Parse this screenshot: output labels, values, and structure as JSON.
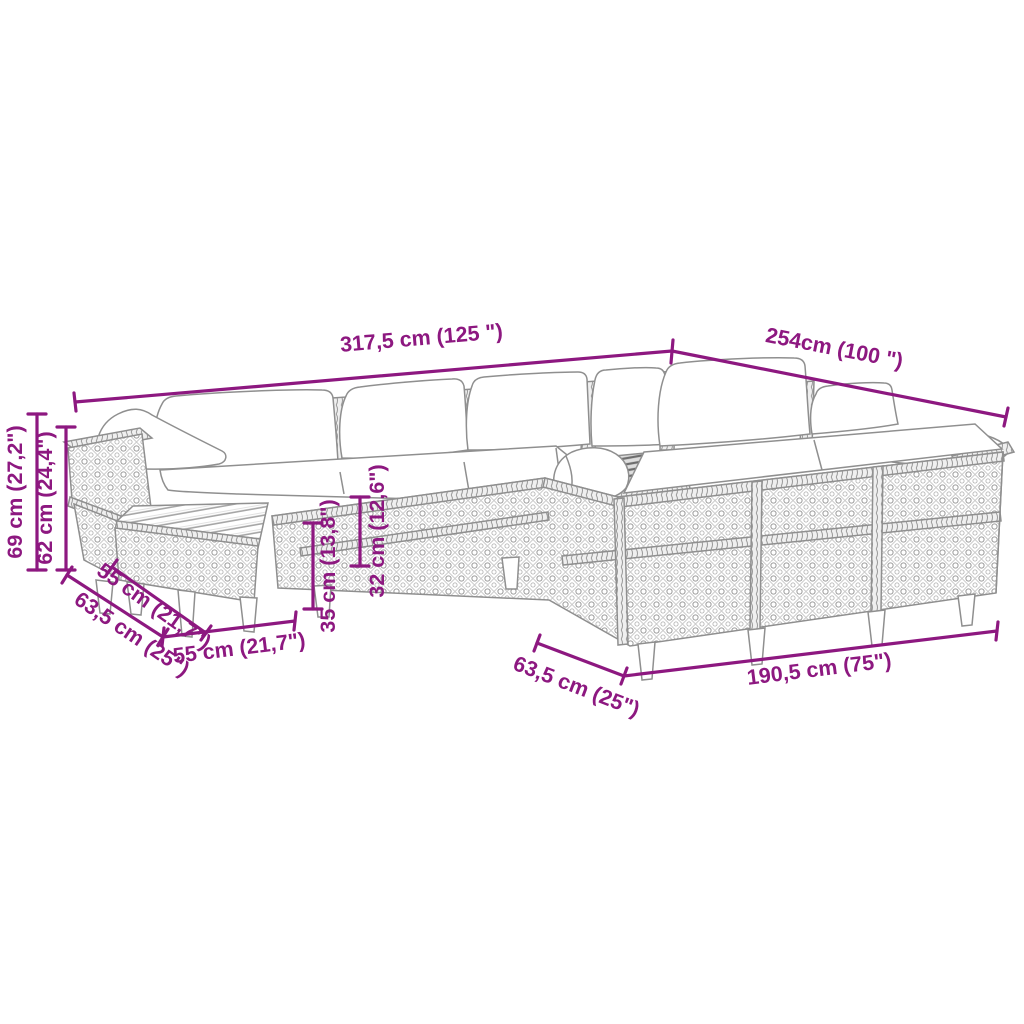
{
  "palette": {
    "dimension_color": "#8D1880",
    "outline_color": "#8F8F8F",
    "hatch_color": "#C6C6C6",
    "slat_dark": "#6E6E6E",
    "cushion_fill": "#FFFFFF",
    "background": "#FFFFFF"
  },
  "dimensions": {
    "back_width": "317,5 cm (125 \")",
    "right_side_width": "254cm (100 \")",
    "total_height": "69 cm (27,2\")",
    "backrest_height": "62 cm (24,4\")",
    "left_module_depth": "63,5 cm (25\")",
    "ottoman_depth": "55 cm (21,7\")",
    "ottoman_width": "55 cm (21,7\")",
    "seat_height": "35 cm (13,8\")",
    "frame_height": "32 cm (12,6\")",
    "right_module_depth": "63,5 cm (25\")",
    "front_width": "190,5 cm (75\")"
  }
}
